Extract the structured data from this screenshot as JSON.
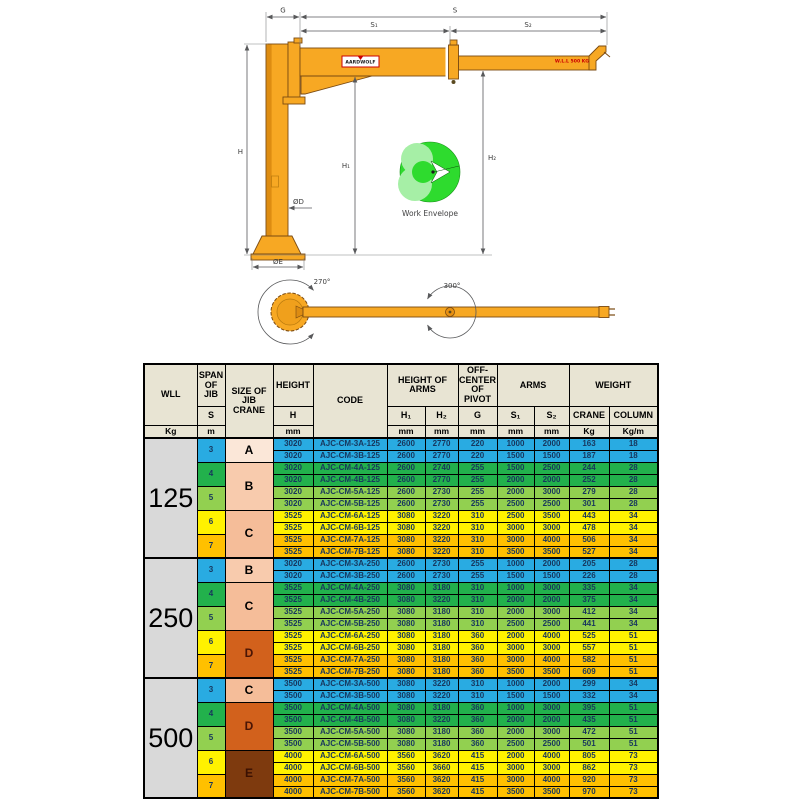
{
  "diagram": {
    "labels": {
      "g": "G",
      "s": "S",
      "s1": "S₁",
      "s2": "S₂",
      "h": "H",
      "h1": "H₁",
      "h2": "H₂",
      "od": "ØD",
      "oe": "ØE",
      "rot_base": "270°",
      "rot_mid": "300°",
      "work_envelope": "Work Envelope",
      "wll_tag": "W.L.L 500 KG",
      "brand": "AARDWOLF"
    },
    "colors": {
      "crane_orange": "#f7a823",
      "crane_shade": "#dd8c12",
      "envelope_green": "#2edb2e",
      "envelope_light": "#a6efa6"
    }
  },
  "table": {
    "header": {
      "wll": "WLL",
      "wll_unit": "Kg",
      "span": "SPAN OF JIB",
      "span_sym": "S",
      "span_unit": "m",
      "size": "SIZE OF JIB CRANE",
      "height": "HEIGHT",
      "height_sym": "H",
      "height_unit": "mm",
      "code": "CODE",
      "height_of_arms": "HEIGHT OF ARMS",
      "h1_sym": "H₁",
      "h2_sym": "H₂",
      "h1_unit": "mm",
      "h2_unit": "mm",
      "off_center": "OFF-CENTER OF PIVOT",
      "g_sym": "G",
      "g_unit": "mm",
      "arms": "ARMS",
      "s1_sym": "S₁",
      "s2_sym": "S₂",
      "s1_unit": "mm",
      "s2_unit": "mm",
      "weight": "WEIGHT",
      "crane": "CRANE",
      "column": "COLUMN",
      "crane_unit": "Kg",
      "column_unit": "Kg/m"
    },
    "palette": {
      "blue": "#29abe2",
      "green": "#22b14c",
      "lightgreen": "#92d050",
      "yellow": "#fff200",
      "orange": "#ffc000"
    },
    "spans": [
      {
        "label": "3",
        "color": "blue"
      },
      {
        "label": "4",
        "color": "green"
      },
      {
        "label": "5",
        "color": "lightgreen"
      },
      {
        "label": "6",
        "color": "yellow"
      },
      {
        "label": "7",
        "color": "orange"
      }
    ],
    "groups": [
      {
        "wll": "125",
        "sizes": [
          {
            "label": "A",
            "rowspan": 2,
            "bg": "#fbe7d8",
            "fg": "#000000"
          },
          {
            "label": "B",
            "rowspan": 4,
            "bg": "#f8cbad",
            "fg": "#000000"
          },
          {
            "label": "C",
            "rowspan": 4,
            "bg": "#f5bd99",
            "fg": "#000000"
          }
        ],
        "rows": [
          {
            "height": "3020",
            "code": "AJC-CM-3A-125",
            "h1": "2600",
            "h2": "2770",
            "g": "220",
            "s1": "1000",
            "s2": "2000",
            "crane": "163",
            "column": "18",
            "color": "blue"
          },
          {
            "height": "3020",
            "code": "AJC-CM-3B-125",
            "h1": "2600",
            "h2": "2770",
            "g": "220",
            "s1": "1500",
            "s2": "1500",
            "crane": "187",
            "column": "18",
            "color": "blue"
          },
          {
            "height": "3020",
            "code": "AJC-CM-4A-125",
            "h1": "2600",
            "h2": "2740",
            "g": "255",
            "s1": "1500",
            "s2": "2500",
            "crane": "244",
            "column": "28",
            "color": "green"
          },
          {
            "height": "3020",
            "code": "AJC-CM-4B-125",
            "h1": "2600",
            "h2": "2770",
            "g": "255",
            "s1": "2000",
            "s2": "2000",
            "crane": "252",
            "column": "28",
            "color": "green"
          },
          {
            "height": "3020",
            "code": "AJC-CM-5A-125",
            "h1": "2600",
            "h2": "2730",
            "g": "255",
            "s1": "2000",
            "s2": "3000",
            "crane": "279",
            "column": "28",
            "color": "lightgreen"
          },
          {
            "height": "3020",
            "code": "AJC-CM-5B-125",
            "h1": "2600",
            "h2": "2730",
            "g": "255",
            "s1": "2500",
            "s2": "2500",
            "crane": "301",
            "column": "28",
            "color": "lightgreen"
          },
          {
            "height": "3525",
            "code": "AJC-CM-6A-125",
            "h1": "3080",
            "h2": "3220",
            "g": "310",
            "s1": "2500",
            "s2": "3500",
            "crane": "443",
            "column": "34",
            "color": "yellow"
          },
          {
            "height": "3525",
            "code": "AJC-CM-6B-125",
            "h1": "3080",
            "h2": "3220",
            "g": "310",
            "s1": "3000",
            "s2": "3000",
            "crane": "478",
            "column": "34",
            "color": "yellow"
          },
          {
            "height": "3525",
            "code": "AJC-CM-7A-125",
            "h1": "3080",
            "h2": "3220",
            "g": "310",
            "s1": "3000",
            "s2": "4000",
            "crane": "506",
            "column": "34",
            "color": "orange"
          },
          {
            "height": "3525",
            "code": "AJC-CM-7B-125",
            "h1": "3080",
            "h2": "3220",
            "g": "310",
            "s1": "3500",
            "s2": "3500",
            "crane": "527",
            "column": "34",
            "color": "orange"
          }
        ]
      },
      {
        "wll": "250",
        "sizes": [
          {
            "label": "B",
            "rowspan": 2,
            "bg": "#f8cbad",
            "fg": "#000000"
          },
          {
            "label": "C",
            "rowspan": 4,
            "bg": "#f5bd99",
            "fg": "#000000"
          },
          {
            "label": "D",
            "rowspan": 4,
            "bg": "#d2611c",
            "fg": "#4a1505"
          }
        ],
        "rows": [
          {
            "height": "3020",
            "code": "AJC-CM-3A-250",
            "h1": "2600",
            "h2": "2730",
            "g": "255",
            "s1": "1000",
            "s2": "2000",
            "crane": "205",
            "column": "28",
            "color": "blue"
          },
          {
            "height": "3020",
            "code": "AJC-CM-3B-250",
            "h1": "2600",
            "h2": "2730",
            "g": "255",
            "s1": "1500",
            "s2": "1500",
            "crane": "226",
            "column": "28",
            "color": "blue"
          },
          {
            "height": "3525",
            "code": "AJC-CM-4A-250",
            "h1": "3080",
            "h2": "3180",
            "g": "310",
            "s1": "1000",
            "s2": "3000",
            "crane": "335",
            "column": "34",
            "color": "green"
          },
          {
            "height": "3525",
            "code": "AJC-CM-4B-250",
            "h1": "3080",
            "h2": "3220",
            "g": "310",
            "s1": "2000",
            "s2": "2000",
            "crane": "375",
            "column": "34",
            "color": "green"
          },
          {
            "height": "3525",
            "code": "AJC-CM-5A-250",
            "h1": "3080",
            "h2": "3180",
            "g": "310",
            "s1": "2000",
            "s2": "3000",
            "crane": "412",
            "column": "34",
            "color": "lightgreen"
          },
          {
            "height": "3525",
            "code": "AJC-CM-5B-250",
            "h1": "3080",
            "h2": "3180",
            "g": "310",
            "s1": "2500",
            "s2": "2500",
            "crane": "441",
            "column": "34",
            "color": "lightgreen"
          },
          {
            "height": "3525",
            "code": "AJC-CM-6A-250",
            "h1": "3080",
            "h2": "3180",
            "g": "360",
            "s1": "2000",
            "s2": "4000",
            "crane": "525",
            "column": "51",
            "color": "yellow"
          },
          {
            "height": "3525",
            "code": "AJC-CM-6B-250",
            "h1": "3080",
            "h2": "3180",
            "g": "360",
            "s1": "3000",
            "s2": "3000",
            "crane": "557",
            "column": "51",
            "color": "yellow"
          },
          {
            "height": "3525",
            "code": "AJC-CM-7A-250",
            "h1": "3080",
            "h2": "3180",
            "g": "360",
            "s1": "3000",
            "s2": "4000",
            "crane": "582",
            "column": "51",
            "color": "orange"
          },
          {
            "height": "3525",
            "code": "AJC-CM-7B-250",
            "h1": "3080",
            "h2": "3180",
            "g": "360",
            "s1": "3500",
            "s2": "3500",
            "crane": "609",
            "column": "51",
            "color": "orange"
          }
        ]
      },
      {
        "wll": "500",
        "sizes": [
          {
            "label": "C",
            "rowspan": 2,
            "bg": "#f5bd99",
            "fg": "#000000"
          },
          {
            "label": "D",
            "rowspan": 4,
            "bg": "#d2611c",
            "fg": "#4a1505"
          },
          {
            "label": "E",
            "rowspan": 4,
            "bg": "#7e3a0e",
            "fg": "#3a1002"
          }
        ],
        "rows": [
          {
            "height": "3500",
            "code": "AJC-CM-3A-500",
            "h1": "3080",
            "h2": "3220",
            "g": "310",
            "s1": "1000",
            "s2": "2000",
            "crane": "299",
            "column": "34",
            "color": "blue"
          },
          {
            "height": "3500",
            "code": "AJC-CM-3B-500",
            "h1": "3080",
            "h2": "3220",
            "g": "310",
            "s1": "1500",
            "s2": "1500",
            "crane": "332",
            "column": "34",
            "color": "blue"
          },
          {
            "height": "3500",
            "code": "AJC-CM-4A-500",
            "h1": "3080",
            "h2": "3180",
            "g": "360",
            "s1": "1000",
            "s2": "3000",
            "crane": "395",
            "column": "51",
            "color": "green"
          },
          {
            "height": "3500",
            "code": "AJC-CM-4B-500",
            "h1": "3080",
            "h2": "3220",
            "g": "360",
            "s1": "2000",
            "s2": "2000",
            "crane": "435",
            "column": "51",
            "color": "green"
          },
          {
            "height": "3500",
            "code": "AJC-CM-5A-500",
            "h1": "3080",
            "h2": "3180",
            "g": "360",
            "s1": "2000",
            "s2": "3000",
            "crane": "472",
            "column": "51",
            "color": "lightgreen"
          },
          {
            "height": "3500",
            "code": "AJC-CM-5B-500",
            "h1": "3080",
            "h2": "3180",
            "g": "360",
            "s1": "2500",
            "s2": "2500",
            "crane": "501",
            "column": "51",
            "color": "lightgreen"
          },
          {
            "height": "4000",
            "code": "AJC-CM-6A-500",
            "h1": "3560",
            "h2": "3620",
            "g": "415",
            "s1": "2000",
            "s2": "4000",
            "crane": "805",
            "column": "73",
            "color": "yellow"
          },
          {
            "height": "4000",
            "code": "AJC-CM-6B-500",
            "h1": "3560",
            "h2": "3660",
            "g": "415",
            "s1": "3000",
            "s2": "3000",
            "crane": "862",
            "column": "73",
            "color": "yellow"
          },
          {
            "height": "4000",
            "code": "AJC-CM-7A-500",
            "h1": "3560",
            "h2": "3620",
            "g": "415",
            "s1": "3000",
            "s2": "4000",
            "crane": "920",
            "column": "73",
            "color": "orange"
          },
          {
            "height": "4000",
            "code": "AJC-CM-7B-500",
            "h1": "3560",
            "h2": "3620",
            "g": "415",
            "s1": "3500",
            "s2": "3500",
            "crane": "970",
            "column": "73",
            "color": "orange"
          }
        ]
      }
    ]
  }
}
